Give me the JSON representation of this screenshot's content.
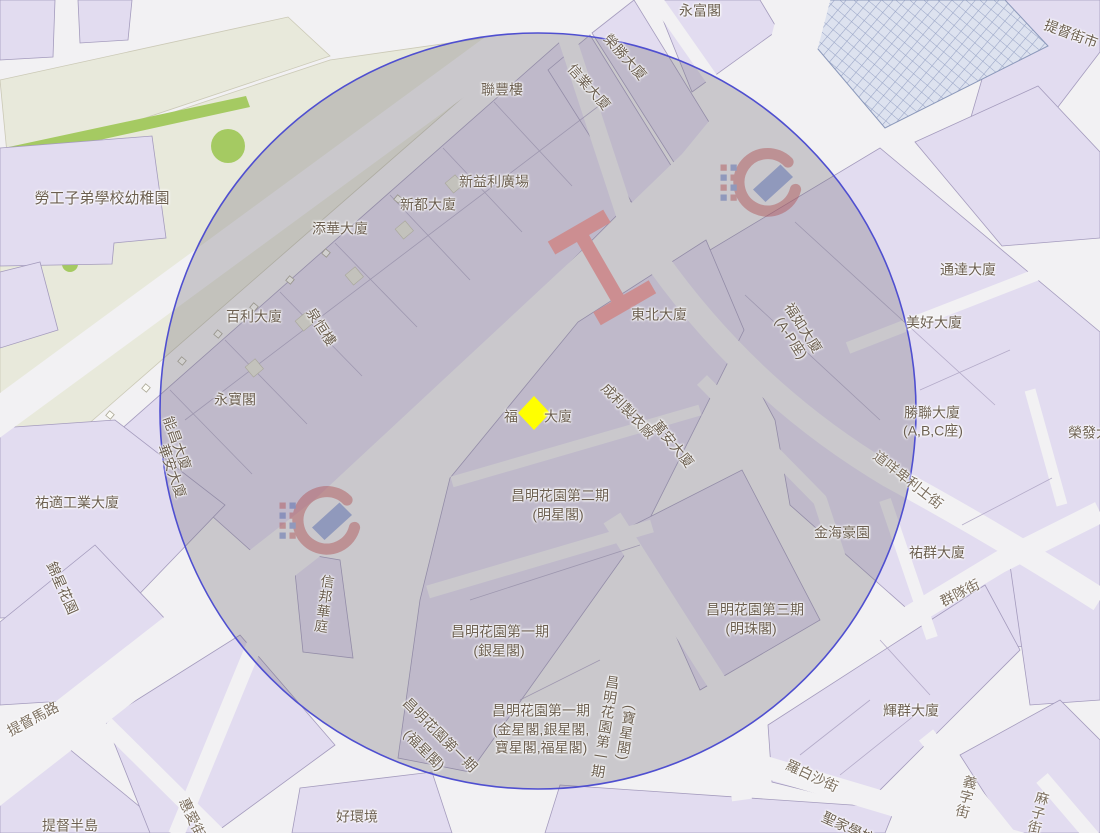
{
  "map": {
    "description": "Map viewer screenshot with a circular search-radius overlay and a yellow diamond location marker",
    "colors": {
      "roads": "#f2f1f3",
      "blocks": "#e2dcf0",
      "pale_ground": "#e8e9db",
      "green": "#a5ca62",
      "circle_stroke": "#4f4fd0",
      "circle_fill": "rgba(108,105,115,0.30)",
      "marker": "#ffff00",
      "bridge": "#f59e9e",
      "label_text": "#6c5f50"
    },
    "selection_circle": {
      "center_x": 538,
      "center_y": 411,
      "radius": 378
    },
    "marker": {
      "shape": "diamond",
      "x": 534,
      "y": 413
    },
    "labels": [
      {
        "text": "勞工子弟學校幼稚園",
        "x": 102,
        "y": 199,
        "fs": 15
      },
      {
        "text": "永富閣",
        "x": 700,
        "y": 11
      },
      {
        "text": "聯豐樓",
        "x": 502,
        "y": 90
      },
      {
        "text": "新益利廣場",
        "x": 494,
        "y": 182
      },
      {
        "text": "新都大廈",
        "x": 428,
        "y": 205
      },
      {
        "text": "添華大廈",
        "x": 340,
        "y": 229
      },
      {
        "text": "百利大廈",
        "x": 254,
        "y": 317
      },
      {
        "text": "泉恒樓",
        "x": 321,
        "y": 327,
        "r": 57
      },
      {
        "text": "永寶閣",
        "x": 235,
        "y": 400
      },
      {
        "text": "能昌大廈",
        "x": 177,
        "y": 443,
        "r": 70
      },
      {
        "text": "華安大廈",
        "x": 172,
        "y": 471,
        "r": 70
      },
      {
        "text": "祐適工業大廈",
        "x": 77,
        "y": 503
      },
      {
        "text": "榮勝大廈",
        "x": 625,
        "y": 57,
        "r": 48
      },
      {
        "text": "信業大廈",
        "x": 589,
        "y": 87,
        "r": 48
      },
      {
        "text": "提督街市",
        "x": 1071,
        "y": 34,
        "r": 20
      },
      {
        "text": "通達大廈",
        "x": 968,
        "y": 270
      },
      {
        "text": "美好大廈",
        "x": 934,
        "y": 323
      },
      {
        "text": "福如大廈",
        "x": 803,
        "y": 328,
        "r": 57
      },
      {
        "text": "(A-P座)",
        "x": 791,
        "y": 338,
        "r": 57
      },
      {
        "text": "勝聯大廈",
        "x": 932,
        "y": 413
      },
      {
        "text": "(A,B,C座)",
        "x": 933,
        "y": 431
      },
      {
        "text": "榮發大廈",
        "x": 1096,
        "y": 433
      },
      {
        "text": "東北大廈",
        "x": 659,
        "y": 315
      },
      {
        "text": "福",
        "x": 511,
        "y": 417
      },
      {
        "text": "大廈",
        "x": 558,
        "y": 417
      },
      {
        "text": "成利製衣廠",
        "x": 628,
        "y": 411,
        "r": 46
      },
      {
        "text": "萬安大廈",
        "x": 673,
        "y": 444,
        "r": 50
      },
      {
        "text": "昌明花園第二期",
        "x": 560,
        "y": 496
      },
      {
        "text": "(明星閣)",
        "x": 558,
        "y": 515
      },
      {
        "text": "昌明花園第三期",
        "x": 755,
        "y": 610
      },
      {
        "text": "(明珠閣)",
        "x": 751,
        "y": 629
      },
      {
        "text": "金海豪園",
        "x": 842,
        "y": 533
      },
      {
        "text": "祐群大廈",
        "x": 937,
        "y": 553
      },
      {
        "text": "道咩卑利士街",
        "x": 908,
        "y": 480,
        "r": 38,
        "k": "street"
      },
      {
        "text": "群隊街",
        "x": 960,
        "y": 593,
        "r": -27,
        "k": "street"
      },
      {
        "text": "羅白沙街",
        "x": 812,
        "y": 776,
        "r": 25,
        "k": "street"
      },
      {
        "text": "義字街",
        "x": 966,
        "y": 797,
        "v": 1,
        "r": 14,
        "k": "street"
      },
      {
        "text": "麻子街",
        "x": 1038,
        "y": 813,
        "v": 1,
        "r": 14,
        "k": "street"
      },
      {
        "text": "輝群大廈",
        "x": 911,
        "y": 711
      },
      {
        "text": "聖家學校",
        "x": 848,
        "y": 828,
        "r": 25
      },
      {
        "text": "好環境",
        "x": 357,
        "y": 817
      },
      {
        "text": "提督半島",
        "x": 70,
        "y": 826
      },
      {
        "text": "提督馬路",
        "x": 33,
        "y": 719,
        "r": -28,
        "k": "street"
      },
      {
        "text": "錦星花園",
        "x": 62,
        "y": 588,
        "r": 66
      },
      {
        "text": "惠愛街",
        "x": 192,
        "y": 818,
        "r": 65,
        "k": "street"
      },
      {
        "text": "信邦華庭",
        "x": 324,
        "y": 604,
        "v": 1,
        "r": 8
      },
      {
        "text": "昌明花園第一期",
        "x": 500,
        "y": 632
      },
      {
        "text": "(銀星閣)",
        "x": 499,
        "y": 651
      },
      {
        "text": "昌明花園第一期",
        "x": 541,
        "y": 711
      },
      {
        "text": "(金星閣,銀星閣,",
        "x": 541,
        "y": 730
      },
      {
        "text": "寶星閣,福星閣)",
        "x": 541,
        "y": 748
      },
      {
        "text": "昌明花園第一期",
        "x": 440,
        "y": 735,
        "r": 45
      },
      {
        "text": "(福星閣)",
        "x": 424,
        "y": 750,
        "r": 45
      },
      {
        "text": "昌明花園第一期",
        "x": 605,
        "y": 727,
        "v": 1,
        "r": 9
      },
      {
        "text": "(寶星閣)",
        "x": 626,
        "y": 733,
        "v": 1,
        "r": 9
      }
    ]
  }
}
